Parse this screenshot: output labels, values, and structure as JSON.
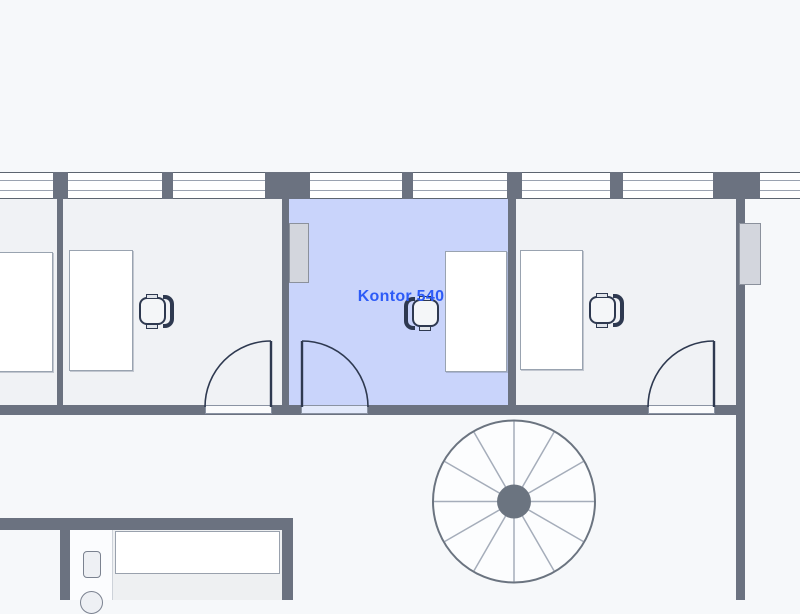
{
  "floor_plan": {
    "highlighted_room": {
      "label": "Kontor 540",
      "label_color": "#2d5bf7",
      "fill": "#c9d4fb"
    },
    "colors": {
      "background": "#f6f8fa",
      "room_fill": "#f0f2f5",
      "wall": "#6b7280",
      "furniture_stroke": "#2e3950",
      "window_glass": "#ffffff",
      "radiator_fill": "#d3d6dd",
      "stair_hub": "#6b7480"
    },
    "elements": [
      "window",
      "door",
      "desk",
      "office-chair",
      "radiator",
      "spiral-staircase",
      "toilet",
      "counter"
    ]
  }
}
